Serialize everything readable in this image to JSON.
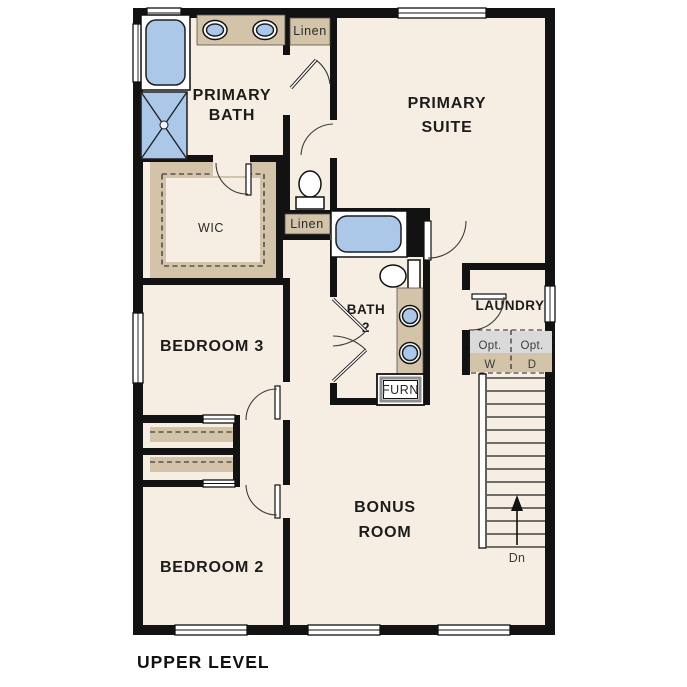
{
  "title": "UPPER LEVEL",
  "colors": {
    "wall": "#121212",
    "floor": "#f6eee2",
    "tan": "#d2c3a9",
    "blue": "#abc8e8",
    "gray": "#dadada"
  },
  "rooms": {
    "primary_bath": {
      "line1": "PRIMARY",
      "line2": "BATH"
    },
    "primary_suite": {
      "line1": "PRIMARY",
      "line2": "SUITE"
    },
    "wic": {
      "label": "WIC"
    },
    "bedroom3": {
      "label": "BEDROOM 3"
    },
    "bath2": {
      "line1": "BATH",
      "line2": "2"
    },
    "laundry": {
      "label": "LAUNDRY"
    },
    "bonus_room": {
      "line1": "BONUS",
      "line2": "ROOM"
    },
    "bedroom2": {
      "label": "BEDROOM 2"
    }
  },
  "closets": {
    "linen_top": {
      "label": "Linen"
    },
    "linen_hall": {
      "label": "Linen"
    }
  },
  "equipment": {
    "furnace": {
      "label": "FURN"
    },
    "washer": {
      "line1": "Opt.",
      "line2": "W"
    },
    "dryer": {
      "line1": "Opt.",
      "line2": "D"
    }
  },
  "stairs": {
    "down_label": "Dn"
  }
}
